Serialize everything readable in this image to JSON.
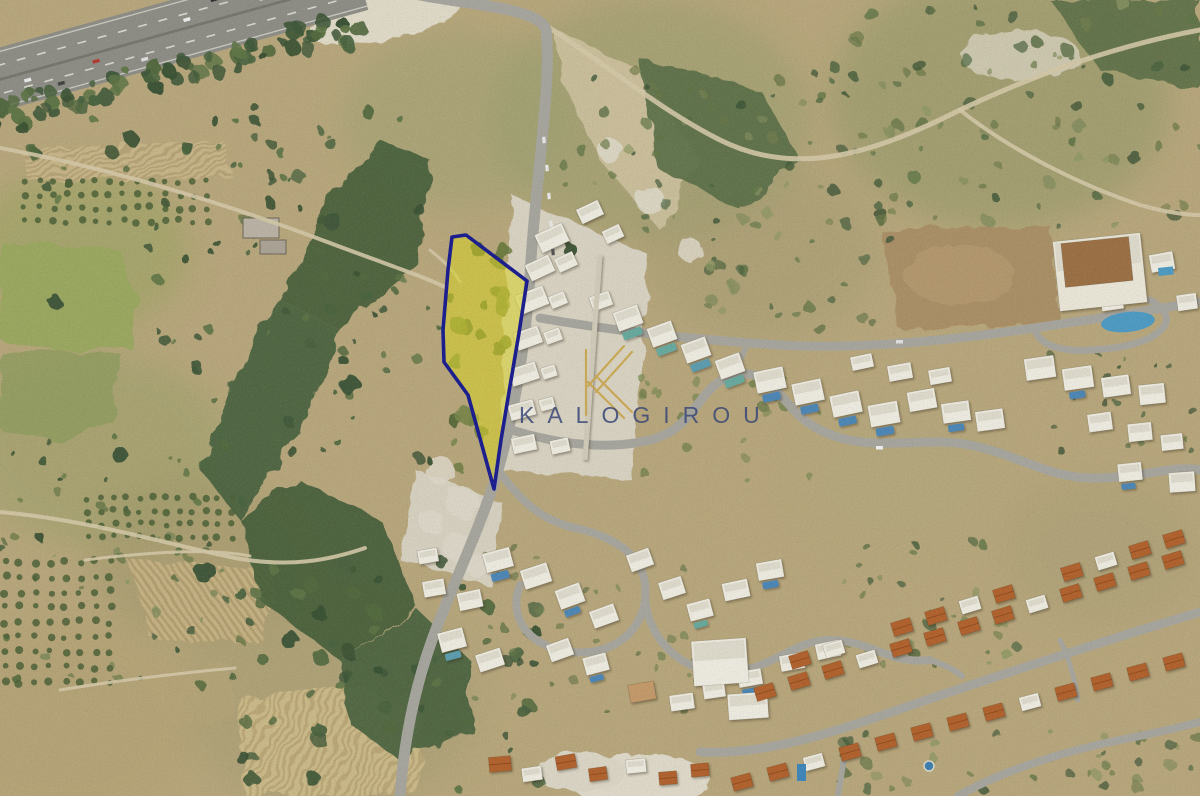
{
  "page": {
    "kind": "satellite-map-listing",
    "description": "Aerial satellite photograph with a highlighted land plot for sale"
  },
  "watermark": {
    "text": "KALOGIROU",
    "text_color": "#3a4878",
    "text_opacity": 0.85,
    "font_size_px": 23,
    "letter_spacing_px": 13,
    "position": {
      "x": 519,
      "y": 423
    },
    "logo": "kalogirou-monogram-icon",
    "logo_color": "#c8a54e"
  },
  "plot_overlay": {
    "label": "highlighted-land-plot",
    "fill_color": "#d9d426",
    "fill_opacity": 0.55,
    "border_color": "#1b1e8e",
    "border_width": 3.6,
    "points": "452,237 466,235 527,281 519,333 509,392 501,440 494,489 468,395 444,362 443,330 448,270"
  },
  "map_features": {
    "highway": "motorway crossing top-left corner",
    "left_area": "green fields and olive groves",
    "center": "scrubland with ravine vegetation and access road",
    "right_area": "hillside residential development with villas, pools and terracotta-roof houses"
  }
}
